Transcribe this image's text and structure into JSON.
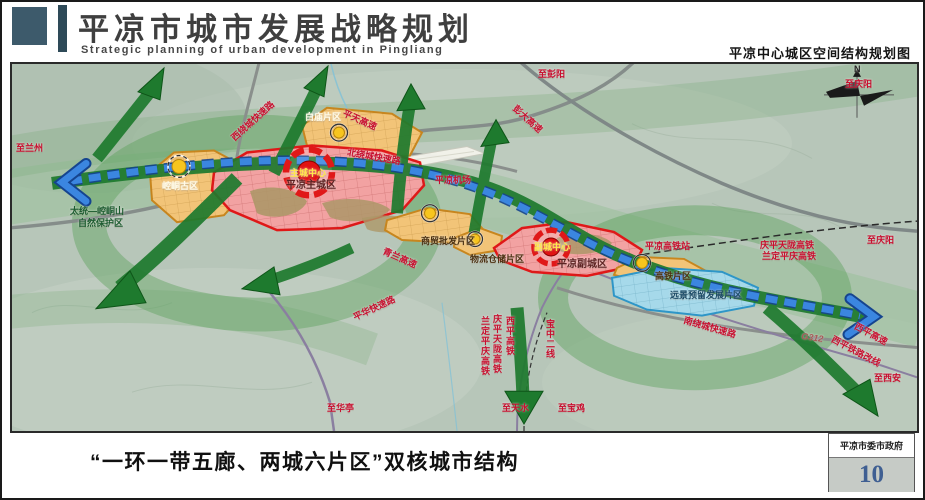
{
  "header": {
    "title": "平凉市城市发展战略规划",
    "subtitle": "Strategic planning of urban development in Pingliang",
    "map_title": "平凉中心城区空间结构规划图"
  },
  "footer": {
    "caption": "“一环一带五廊、两城六片区”双核城市结构",
    "agency": "平凉市委市政府",
    "page_number": "10"
  },
  "colors": {
    "header_block": "#3d5a6b",
    "header_bar": "#2e4a58",
    "page_number": "#3f5f92",
    "terrain": "#b7c6b9",
    "corridor_green": "#1e7a2e",
    "ring_green": "#58a058",
    "axis_blue": "#3b86e0",
    "axis_blue_dark": "#15448f",
    "zone_red_fill": "#f2a2a2",
    "zone_red_stroke": "#e01818",
    "zone_orange_fill": "#f2c478",
    "zone_orange_stroke": "#c8861e",
    "zone_blue_fill": "#a6d9ea",
    "zone_blue_stroke": "#2e96c8",
    "node_yellow": "#f7c51e"
  },
  "map": {
    "labels": [
      {
        "name": "label-baimiao-district",
        "text": "白庙片区",
        "x": 293,
        "y": 49,
        "color": "#fffbe8",
        "size": 9
      },
      {
        "name": "label-kongtong-old-district",
        "text": "崆峒古区",
        "x": 150,
        "y": 118,
        "color": "#fffbe8",
        "size": 9
      },
      {
        "name": "label-main-city-district",
        "text": "平凉主城区",
        "x": 274,
        "y": 117,
        "color": "#5e2323",
        "size": 10
      },
      {
        "name": "label-main-city-center",
        "text": "主城中心",
        "x": 278,
        "y": 105,
        "color": "#ffe94a",
        "size": 9
      },
      {
        "name": "label-trade-wholesale-district",
        "text": "商贸批发片区",
        "x": 409,
        "y": 173,
        "color": "#4a3010",
        "size": 9
      },
      {
        "name": "label-logistics-district",
        "text": "物流仓储片区",
        "x": 458,
        "y": 191,
        "color": "#4a3010",
        "size": 9
      },
      {
        "name": "label-sub-city-district",
        "text": "平凉副城区",
        "x": 545,
        "y": 196,
        "color": "#5e2323",
        "size": 10
      },
      {
        "name": "label-sub-city-center",
        "text": "副城中心",
        "x": 522,
        "y": 179,
        "color": "#ffe94a",
        "size": 9
      },
      {
        "name": "label-hsr-district",
        "text": "高铁片区",
        "x": 643,
        "y": 208,
        "color": "#4a3010",
        "size": 9
      },
      {
        "name": "label-reserve-development-district",
        "text": "远景预留发展片区",
        "x": 658,
        "y": 227,
        "color": "#1a4a66",
        "size": 9
      },
      {
        "name": "label-airport",
        "text": "平凉机场",
        "x": 423,
        "y": 112,
        "size": 9
      },
      {
        "name": "label-nature-reserve-line1",
        "text": "太统—崆峒山",
        "x": 58,
        "y": 143,
        "color": "#1c5c30",
        "size": 9
      },
      {
        "name": "label-nature-reserve-line2",
        "text": "自然保护区",
        "x": 66,
        "y": 155,
        "color": "#1c5c30",
        "size": 9
      },
      {
        "name": "label-west-ring-expwy",
        "text": "西绕城快速路",
        "x": 218,
        "y": 72,
        "rot": -42,
        "size": 9
      },
      {
        "name": "label-pingtian-expwy",
        "text": "平天高速",
        "x": 333,
        "y": 45,
        "rot": 24,
        "size": 9
      },
      {
        "name": "label-pengda-expwy",
        "text": "彭大高速",
        "x": 505,
        "y": 40,
        "rot": 42,
        "size": 9
      },
      {
        "name": "label-north-ring-expwy",
        "text": "北绕城快速路",
        "x": 336,
        "y": 84,
        "rot": 10,
        "size": 9
      },
      {
        "name": "label-qinglan-expwy",
        "text": "青兰高速",
        "x": 373,
        "y": 183,
        "rot": 24,
        "size": 9
      },
      {
        "name": "label-pinghua-expwy",
        "text": "平华快速路",
        "x": 340,
        "y": 250,
        "rot": -25,
        "size": 9
      },
      {
        "name": "label-south-ring-expwy",
        "text": "南绕城快速路",
        "x": 673,
        "y": 252,
        "rot": 16,
        "size": 9
      },
      {
        "name": "label-g312",
        "text": "G312",
        "x": 790,
        "y": 268,
        "rot": 8,
        "size": 9,
        "italic": true,
        "color": "#a85858"
      },
      {
        "name": "label-xiping-expwy",
        "text": "西平高速",
        "x": 845,
        "y": 258,
        "rot": 28,
        "size": 9
      },
      {
        "name": "label-xiping-railway-reroute",
        "text": "西平铁路改线",
        "x": 822,
        "y": 271,
        "rot": 28,
        "size": 9
      },
      {
        "name": "label-hsr-station",
        "text": "平凉高铁站",
        "x": 633,
        "y": 178,
        "size": 9
      },
      {
        "name": "label-qingpingtianlong-hsr",
        "text": "庆平天陇高铁",
        "x": 748,
        "y": 177,
        "size": 9
      },
      {
        "name": "label-landingpingqing-hsr",
        "text": "兰定平庆高铁",
        "x": 750,
        "y": 188,
        "size": 9
      },
      {
        "name": "label-landingpingqing-hsr-vertical",
        "text": "兰定平庆高铁",
        "x": 468,
        "y": 252,
        "vertical": true,
        "size": 9
      },
      {
        "name": "label-qingpingtianlong-hsr-vertical",
        "text": "庆平天陇高铁",
        "x": 480,
        "y": 250,
        "vertical": true,
        "size": 9
      },
      {
        "name": "label-xiping-hsr-vertical",
        "text": "西平高铁",
        "x": 493,
        "y": 252,
        "vertical": true,
        "size": 9
      },
      {
        "name": "label-baozhong-line2-vertical",
        "text": "宝中二线",
        "x": 533,
        "y": 255,
        "vertical": true,
        "size": 9
      },
      {
        "name": "label-to-lanzhou",
        "text": "至兰州",
        "x": 4,
        "y": 80,
        "size": 9
      },
      {
        "name": "label-to-pengyang",
        "text": "至彭阳",
        "x": 526,
        "y": 6,
        "size": 9
      },
      {
        "name": "label-to-qingyang-top",
        "text": "至庆阳",
        "x": 833,
        "y": 16,
        "size": 9
      },
      {
        "name": "label-to-qingyang-right",
        "text": "至庆阳",
        "x": 855,
        "y": 172,
        "size": 9
      },
      {
        "name": "label-to-xian",
        "text": "至西安",
        "x": 862,
        "y": 310,
        "size": 9
      },
      {
        "name": "label-to-tianshui",
        "text": "至天水",
        "x": 490,
        "y": 340,
        "size": 9
      },
      {
        "name": "label-to-baoji",
        "text": "至宝鸡",
        "x": 546,
        "y": 340,
        "size": 9
      },
      {
        "name": "label-to-huating",
        "text": "至华亭",
        "x": 315,
        "y": 340,
        "size": 9
      },
      {
        "name": "compass-n-label",
        "text": "N",
        "x": 842,
        "y": 1,
        "color": "#222",
        "size": 9
      }
    ]
  }
}
